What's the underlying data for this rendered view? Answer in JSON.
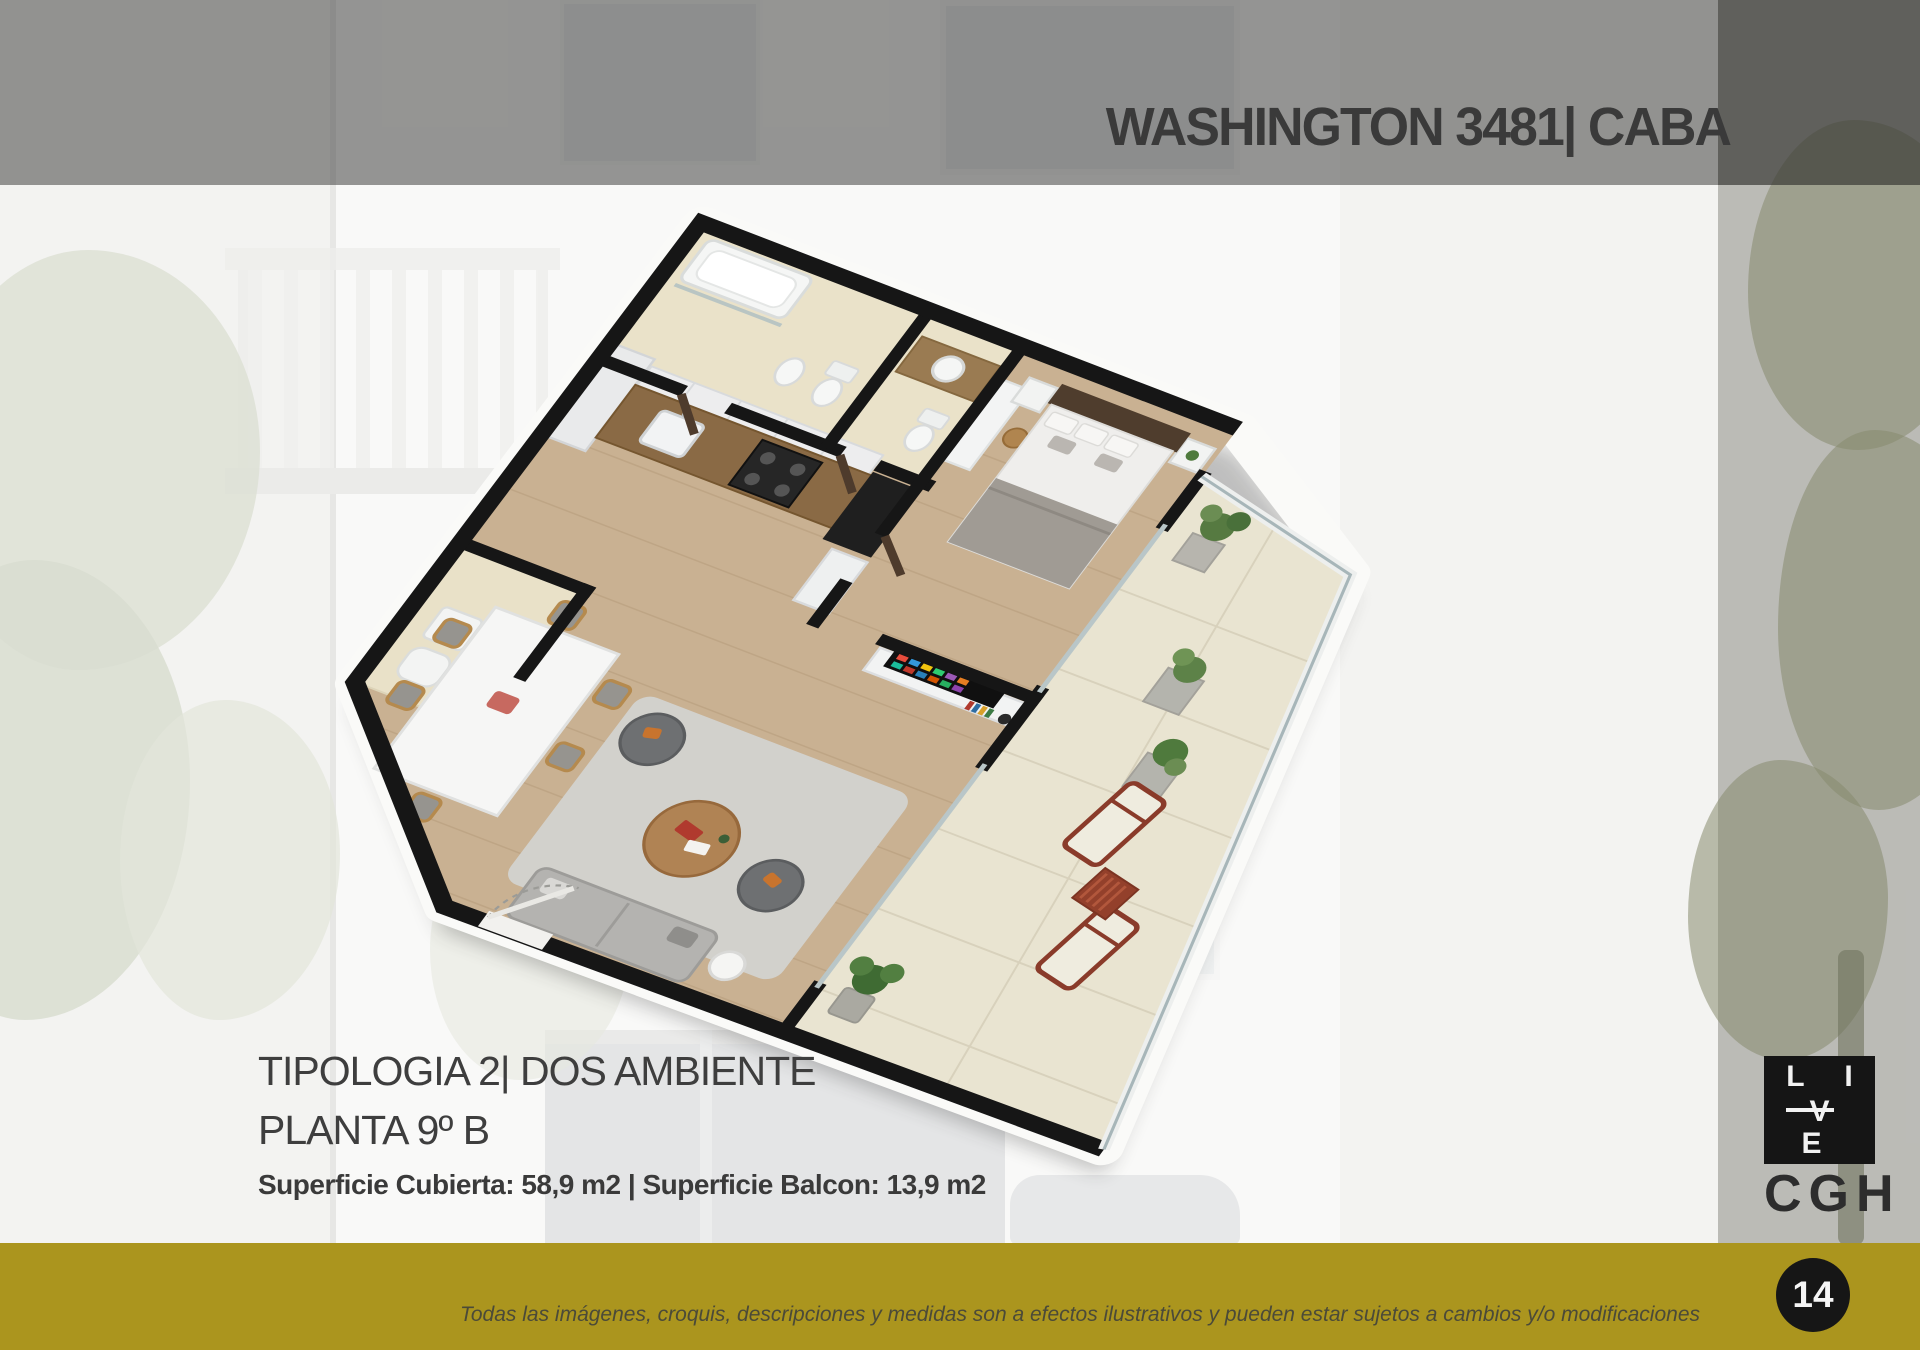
{
  "header": {
    "title": "WASHINGTON 3481| CABA"
  },
  "plan_caption": {
    "typology": "TIPOLOGIA 2| DOS AMBIENTE",
    "floor": "PLANTA 9º B",
    "surfaces": "Superficie Cubierta: 58,9 m2 | Superficie Balcon: 13,9 m2"
  },
  "branding": {
    "live_row1": "L I",
    "live_row2": "V E",
    "company": "CGH"
  },
  "footer": {
    "disclaimer": "Todas las imágenes, croquis, descripciones y medidas son a efectos ilustrativos y pueden estar sujetos a cambios y/o modificaciones",
    "page_number": "14"
  },
  "colors": {
    "accent_gold": "#ab951e",
    "top_band_overlay": "#464644",
    "wall_black": "#161616",
    "page_circle_black": "#161616",
    "title_gray": "#3a3a3a"
  }
}
